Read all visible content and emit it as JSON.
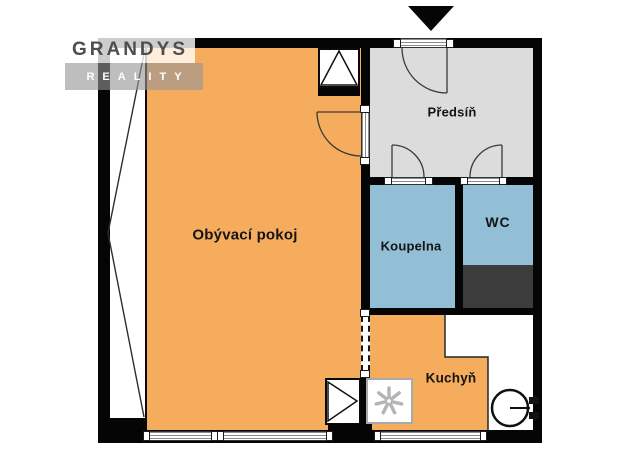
{
  "logo": {
    "line1": "GRANDYS",
    "line2": "REALITY"
  },
  "rooms": {
    "living": {
      "label": "Obývací pokoj"
    },
    "hall": {
      "label": "Předsíň"
    },
    "bathroom": {
      "label": "Koupelna"
    },
    "wc": {
      "label": "WC"
    },
    "kitchen": {
      "label": "Kuchyň"
    }
  },
  "icons": {
    "entrance_marker": "entrance-arrow-icon (black triangle pointing at entry door)",
    "stove": "stove-icon (square with seven-blade asterisk)",
    "water_heater": "water-heater-icon (circle with wall fittings)",
    "duct_top": "duct-icon (square with upward triangle)",
    "duct_bottom": "duct-icon (square with right triangle)"
  },
  "colors": {
    "living_floor": "#F6AC5D",
    "kitchen_floor": "#F6AC5D",
    "hall_floor": "#DCDCDC",
    "bathroom_floor": "#92BFD5",
    "wc_floor": "#92BFD5",
    "shaft_fill": "#3C3C3C",
    "wall": "#050505",
    "logo_text_dark": "#4E4E4E",
    "logo_text_light": "#FFFFFF"
  }
}
